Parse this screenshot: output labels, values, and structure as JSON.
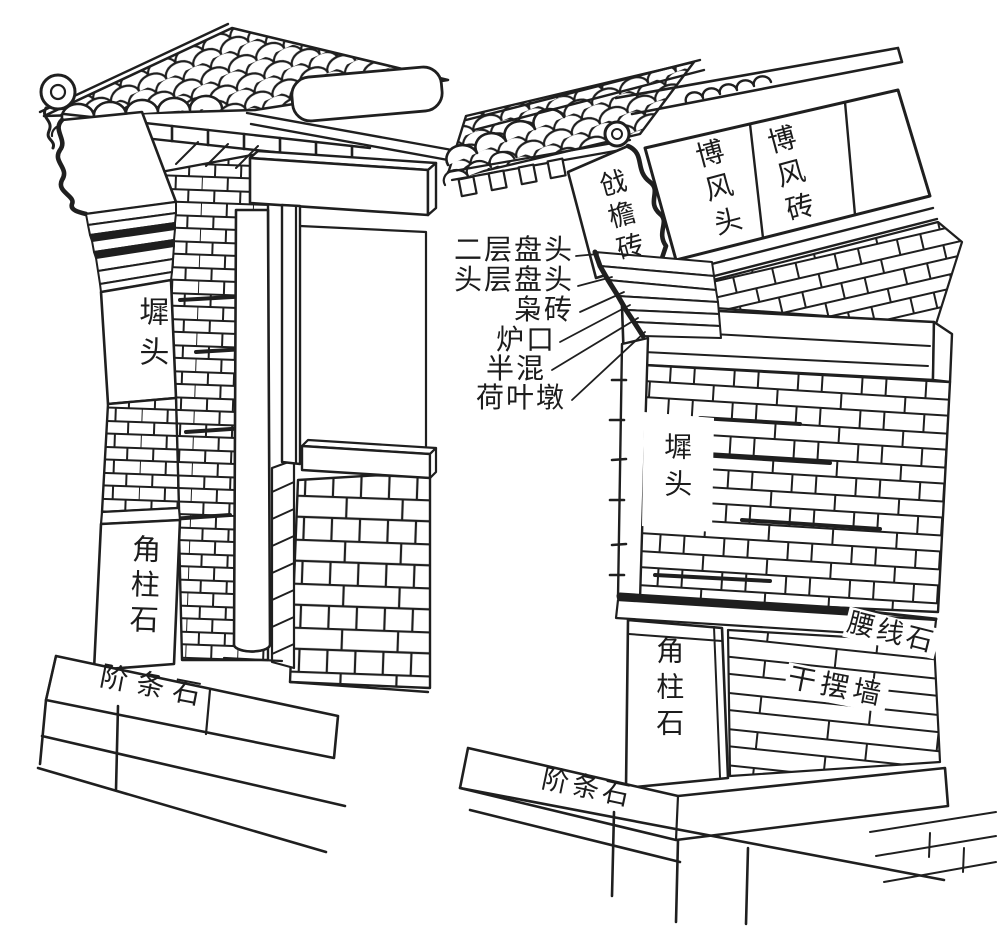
{
  "canvas": {
    "background": "#ffffff",
    "ink": "#1f1f1f"
  },
  "left_drawing": {
    "labels": {
      "chitou": "墀头",
      "jiaozhushi": "角柱石",
      "jietiaoshi": "阶条石"
    }
  },
  "right_drawing": {
    "labels": {
      "qiangyanzhuan": "戗檐砖",
      "bofengtou": "博风头",
      "bofengzhuan": "博风砖",
      "chitou": "墀头",
      "yaoxianshi": "腰线石",
      "ganbaiqiang": "干摆墙",
      "jiaozhushi": "角柱石",
      "jietiaoshi": "阶条石"
    },
    "callouts": [
      {
        "text": "二层盘头"
      },
      {
        "text": "头层盘头"
      },
      {
        "text": "枭砖"
      },
      {
        "text": "炉口"
      },
      {
        "text": "半混"
      },
      {
        "text": "荷叶墩"
      }
    ]
  }
}
